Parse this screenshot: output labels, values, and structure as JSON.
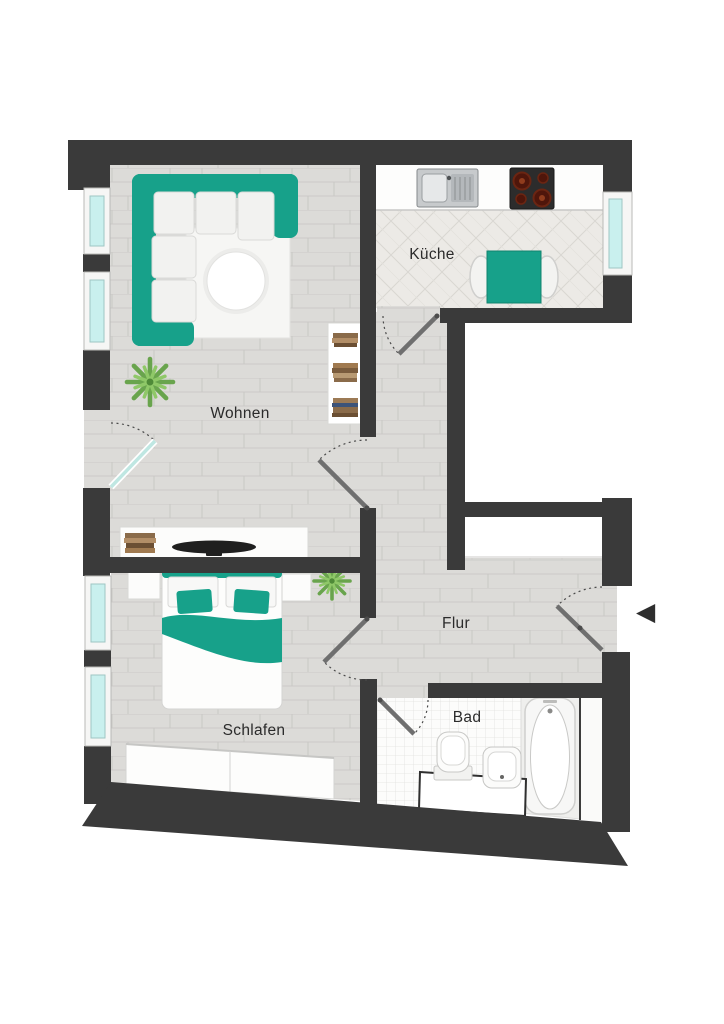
{
  "floorplan": {
    "type": "apartment-floor-plan",
    "rooms": {
      "wohnen": {
        "label": "Wohnen"
      },
      "kueche": {
        "label": "Küche"
      },
      "flur": {
        "label": "Flur"
      },
      "schlafen": {
        "label": "Schlafen"
      },
      "bad": {
        "label": "Bad"
      }
    },
    "entrance": {
      "arrow_glyph": "◀"
    },
    "colors": {
      "wall": "#3a3a3a",
      "accent": "#17a18a",
      "accent_dark": "#0f8574",
      "window": "#c9f0ee",
      "door": "#6f6f6f",
      "label": "#2b2b2b",
      "floor": "#dcdbd8",
      "kitchen_floor": "#eceae6",
      "bath_floor": "#fcfcfb"
    }
  }
}
